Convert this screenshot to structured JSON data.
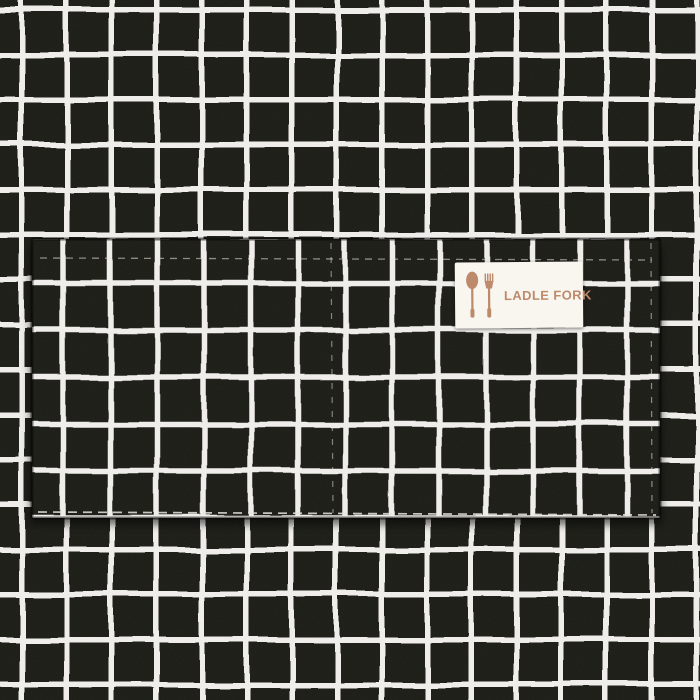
{
  "label": {
    "brand_text": "LADLE FORK",
    "icons": [
      "spoon-icon",
      "fork-icon"
    ]
  },
  "colors": {
    "fabric_black": "#1b1a18",
    "grid_white": "#f1efeb",
    "label_bg": "#f9f6f0",
    "label_accent": "#bd8a6b",
    "stitch_white": "#e8e5df"
  }
}
